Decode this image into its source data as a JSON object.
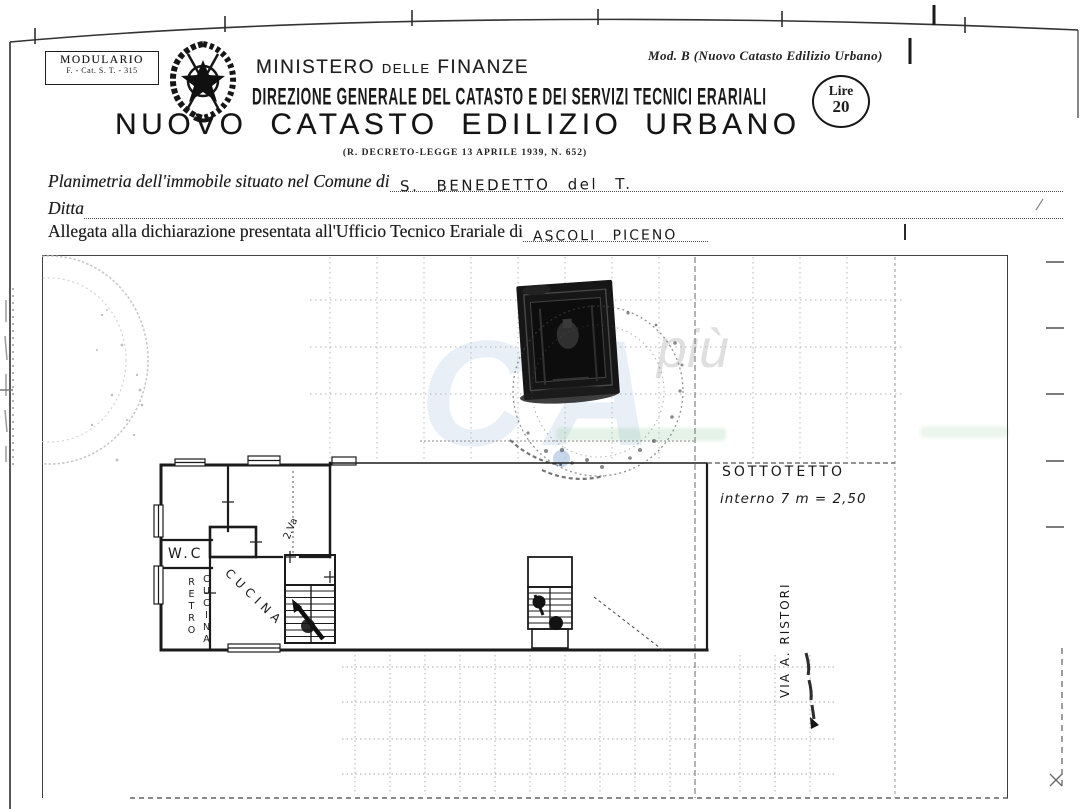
{
  "header": {
    "modulario": {
      "line1": "MODULARIO",
      "line2": "F. - Cat. S. T. - 315"
    },
    "mod_note": "Mod. B (Nuovo Catasto Edilizio Urbano)",
    "ministry": {
      "word1": "MINISTERO",
      "word2": "DELLE",
      "word3": "FINANZE"
    },
    "direzione": "DIREZIONE GENERALE DEL CATASTO E DEI SERVIZI TECNICI ERARIALI",
    "lire": {
      "line1": "Lire",
      "line2": "20"
    },
    "title": "NUOVO CATASTO EDILIZIO URBANO",
    "subtitle": "(R. DECRETO-LEGGE 13 APRILE 1939, N. 652)"
  },
  "form": {
    "planimetria_label": "Planimetria dell'immobile situato nel Comune di",
    "planimetria_value": "S. BENEDETTO  del T.",
    "ditta_label": "Ditta",
    "allegata_label": "Allegata alla dichiarazione presentata all'Ufficio Tecnico Erariale di",
    "allegata_value": "ASCOLI  PICENO"
  },
  "plan": {
    "watermark_big": "CA",
    "watermark_small": "più",
    "sottotetto_line1": "SOTTOTETTO",
    "sottotetto_line2": "interno 7   m = 2,50",
    "street_label": "VIA A. RISTORI",
    "room_wc": "W.C",
    "room_retro_col1": "RETRO",
    "room_retro_col2": "CUCINA",
    "room_cucina": "CUCINA",
    "dim_note": "2.Va"
  }
}
